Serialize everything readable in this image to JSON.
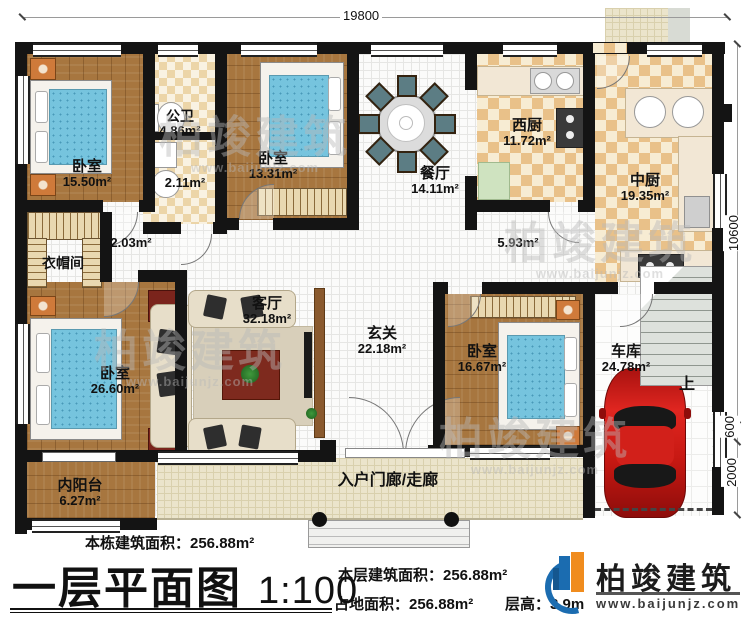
{
  "dimensions": {
    "top": "19800",
    "right": "10600",
    "right_mid": "600",
    "right_low": "2000"
  },
  "rooms": {
    "bedroom1": {
      "label": "卧室",
      "area": "15.50m²"
    },
    "bathroom": {
      "label": "公卫",
      "area": "4.86m²"
    },
    "bath_wet": {
      "area": "2.11m²"
    },
    "bedroom2": {
      "label": "卧室",
      "area": "13.31m²"
    },
    "dining": {
      "label": "餐厅",
      "area": "14.11m²"
    },
    "west_kitchen": {
      "label": "西厨",
      "area": "11.72m²"
    },
    "main_kitchen": {
      "label": "中厨",
      "area": "19.35m²"
    },
    "cloakroom": {
      "label": "衣帽间"
    },
    "hall_left": {
      "area": "2.03m²"
    },
    "hall_right": {
      "area": "5.93m²"
    },
    "master_bedroom": {
      "label": "卧室",
      "area": "26.60m²"
    },
    "living": {
      "label": "客厅",
      "area": "32.18m²"
    },
    "foyer": {
      "label": "玄关",
      "area": "22.18m²"
    },
    "bedroom3": {
      "label": "卧室",
      "area": "16.67m²"
    },
    "garage": {
      "label": "车库",
      "area": "24.78m²"
    },
    "balcony": {
      "label": "内阳台",
      "area": "6.27m²"
    },
    "porch": {
      "label": "入户门廊/走廊"
    }
  },
  "stairs": {
    "up_label": "上"
  },
  "watermark": {
    "text": "柏竣建筑",
    "url": "www.baijunjz.com"
  },
  "title_block": {
    "building_total_area": "本栋建筑面积：256.88m²",
    "title": "一层平面图",
    "scale": "1:100",
    "floor_area": "本层建筑面积：256.88m²",
    "land_area": "占地面积：256.88m²",
    "floor_height": "层高：3.9m",
    "brand_name": "柏竣建筑",
    "brand_url": "www.baijunjz.com"
  },
  "colors": {
    "wall": "#141414",
    "brand_blue": "#1b6cb0",
    "brand_orange": "#f08c1e",
    "car_red": "#cc1f1a",
    "mattress_blue": "#76c4de"
  }
}
